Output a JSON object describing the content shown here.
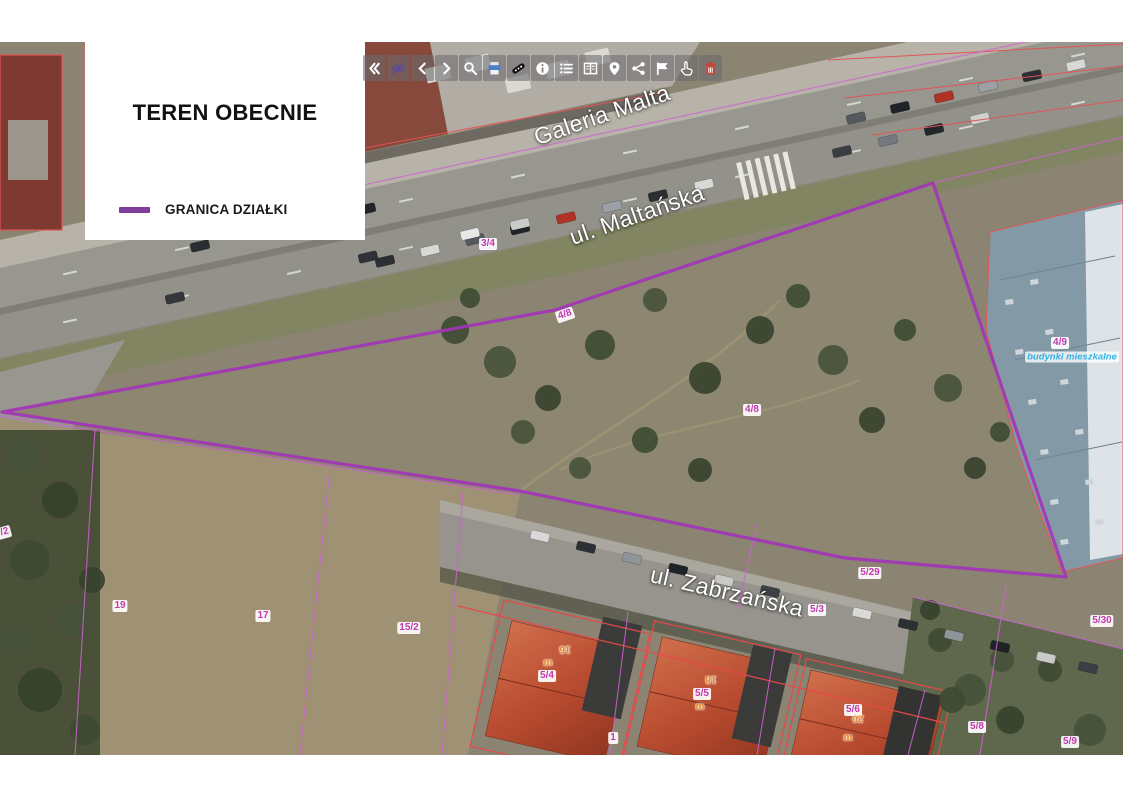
{
  "legend": {
    "title": "TEREN OBECNIE",
    "items": [
      {
        "label": "GRANICA DZIAŁKI",
        "swatch_color": "#7d3f9b"
      }
    ]
  },
  "toolbar": {
    "buttons": [
      {
        "name": "collapse-panel",
        "icon": "angle-double-left"
      },
      {
        "name": "toggle-layer-visibility",
        "icon": "eye-slash"
      },
      {
        "name": "previous-view",
        "icon": "chevron-left"
      },
      {
        "name": "next-view",
        "icon": "chevron-right"
      },
      {
        "name": "search",
        "icon": "search"
      },
      {
        "name": "print",
        "icon": "print"
      },
      {
        "name": "measure",
        "icon": "measure-tape"
      },
      {
        "name": "info",
        "icon": "info-circle"
      },
      {
        "name": "layer-list",
        "icon": "list"
      },
      {
        "name": "attribute-table",
        "icon": "columns"
      },
      {
        "name": "locate",
        "icon": "map-marker"
      },
      {
        "name": "share",
        "icon": "share-nodes"
      },
      {
        "name": "select-area",
        "icon": "flag"
      },
      {
        "name": "pointer-select",
        "icon": "hand-pointer"
      },
      {
        "name": "delete",
        "icon": "trash"
      }
    ]
  },
  "map": {
    "boundary_color": "#a335b8",
    "cadastral_line_color": "#cf62d2",
    "building_outline_color": "#e85050",
    "street_labels": [
      {
        "text": "Galeria Malta",
        "x": 602,
        "y": 115,
        "rotate": -19
      },
      {
        "text": "ul. Maltańska",
        "x": 637,
        "y": 215,
        "rotate": -19
      },
      {
        "text": "ul. Zabrzańska",
        "x": 727,
        "y": 592,
        "rotate": 13
      }
    ],
    "parcel_labels": [
      {
        "text": "3/4",
        "x": 488,
        "y": 244,
        "rotate": 0
      },
      {
        "text": "4/8",
        "x": 565,
        "y": 315,
        "rotate": -19
      },
      {
        "text": "4/8",
        "x": 752,
        "y": 410,
        "rotate": 0
      },
      {
        "text": "4/9",
        "x": 1060,
        "y": 343,
        "rotate": 0
      },
      {
        "text": "5/29",
        "x": 870,
        "y": 573,
        "rotate": 0
      },
      {
        "text": "5/3",
        "x": 817,
        "y": 610,
        "rotate": 0
      },
      {
        "text": "5/30",
        "x": 1102,
        "y": 621,
        "rotate": 0
      },
      {
        "text": "19",
        "x": 120,
        "y": 606,
        "rotate": 0
      },
      {
        "text": "17",
        "x": 263,
        "y": 616,
        "rotate": 0
      },
      {
        "text": "15/2",
        "x": 409,
        "y": 628,
        "rotate": 0
      },
      {
        "text": "5/4",
        "x": 547,
        "y": 676,
        "rotate": 0
      },
      {
        "text": "5/5",
        "x": 702,
        "y": 694,
        "rotate": 0
      },
      {
        "text": "5/6",
        "x": 853,
        "y": 710,
        "rotate": 0
      },
      {
        "text": "5/8",
        "x": 977,
        "y": 727,
        "rotate": 0
      },
      {
        "text": "5/9",
        "x": 1070,
        "y": 742,
        "rotate": 0
      },
      {
        "text": "1",
        "x": 613,
        "y": 738,
        "rotate": 0
      },
      {
        "text": "7/2",
        "x": 2,
        "y": 533,
        "rotate": -15
      }
    ],
    "building_labels": [
      {
        "text": "16",
        "x": 565,
        "y": 649,
        "rotate": 180
      },
      {
        "text": "18",
        "x": 711,
        "y": 679,
        "rotate": 180
      },
      {
        "text": "20",
        "x": 858,
        "y": 718,
        "rotate": 180
      },
      {
        "text": "m",
        "x": 548,
        "y": 663,
        "rotate": 0
      },
      {
        "text": "m",
        "x": 700,
        "y": 707,
        "rotate": 0
      },
      {
        "text": "m",
        "x": 848,
        "y": 738,
        "rotate": 0
      }
    ],
    "area_labels": [
      {
        "text": "budynki mieszkalne",
        "x": 1072,
        "y": 357,
        "rotate": 0
      }
    ]
  }
}
